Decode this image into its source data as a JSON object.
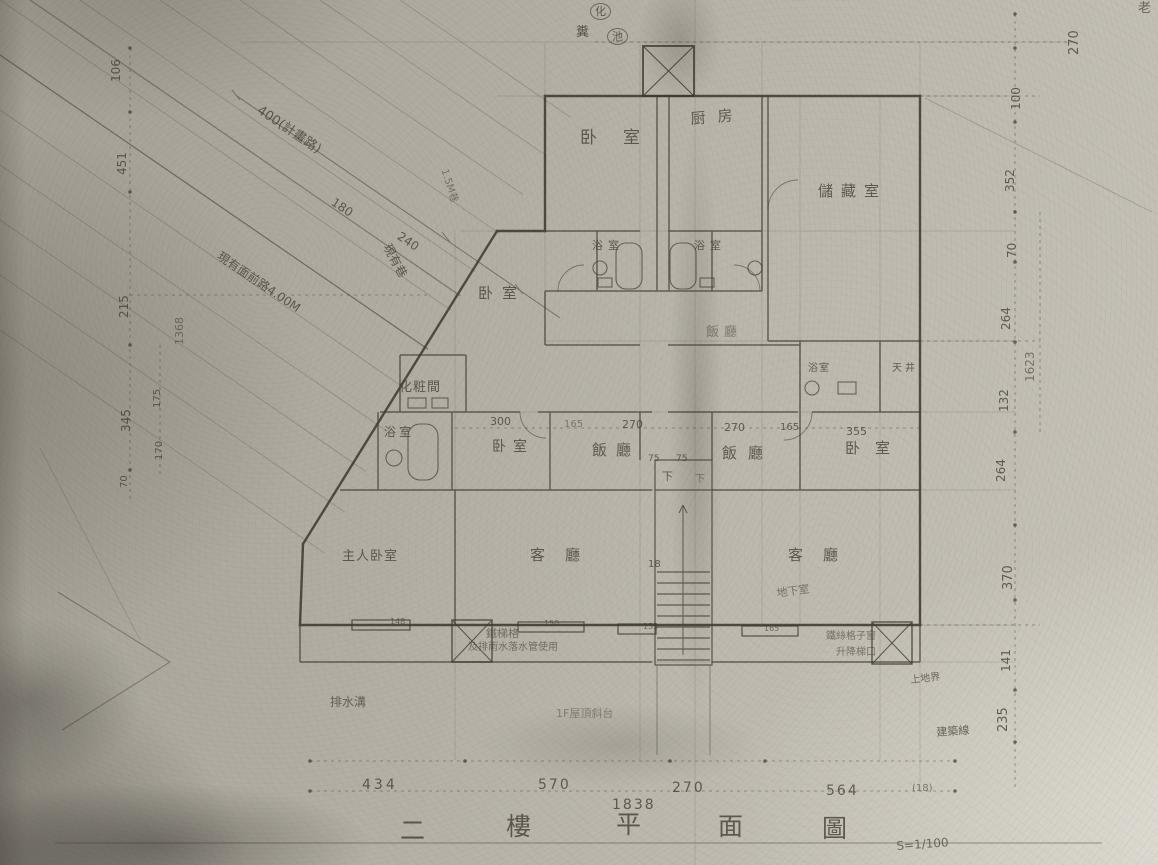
{
  "meta": {
    "doc_title": "二樓平面圖 S=1/100 (scanned floor plan)",
    "drawing_title_chars": [
      "二",
      "樓",
      "平",
      "面",
      "圖"
    ],
    "scale": "S=1/100",
    "floor": "二樓",
    "colors": {
      "paper": "#b8b4aa",
      "ink": "#453f35",
      "faint_ink": "#6b655a"
    }
  },
  "dimension_chains": {
    "bottom": [
      "434",
      "570",
      "270",
      "564"
    ],
    "bottom_total": "1838",
    "bottom_extra": "(18)",
    "middle_row": [
      "300",
      "165",
      "270",
      "270",
      "165",
      "355"
    ],
    "left_outer": [
      "106",
      "451",
      "215",
      "345"
    ],
    "left_inner": [
      "175",
      "170",
      "70"
    ],
    "left_subtotal": "1368",
    "right_outer": [
      "270",
      "100",
      "352",
      "70",
      "264",
      "132",
      "264",
      "370",
      "141",
      "235"
    ],
    "right_subtotal": "1623",
    "road": [
      "400(計畫路)",
      "180",
      "240"
    ],
    "stair": [
      "75",
      "75",
      "18"
    ],
    "wall_tags": [
      "148",
      "150",
      "155",
      "165"
    ]
  },
  "labels": [
    {
      "name": "room-bedroom-top",
      "text": "卧室",
      "x": 580,
      "y": 130,
      "fs": 17,
      "ls": 26
    },
    {
      "name": "room-kitchen",
      "text": "厨房",
      "x": 690,
      "y": 112,
      "fs": 15,
      "ls": 12,
      "rot": -5
    },
    {
      "name": "room-storage",
      "text": "儲藏室",
      "x": 818,
      "y": 184,
      "fs": 15,
      "ls": 8
    },
    {
      "name": "room-bath-a",
      "text": "浴室",
      "x": 592,
      "y": 240,
      "fs": 11,
      "ls": 5
    },
    {
      "name": "room-bath-b",
      "text": "浴室",
      "x": 694,
      "y": 240,
      "fs": 11,
      "ls": 5
    },
    {
      "name": "room-bedroom-left",
      "text": "卧室",
      "x": 478,
      "y": 286,
      "fs": 15,
      "ls": 9
    },
    {
      "name": "room-dining-upper",
      "text": "飯廳",
      "x": 706,
      "y": 326,
      "fs": 13,
      "ls": 5,
      "op": 0.5
    },
    {
      "name": "room-dressing",
      "text": "化粧間",
      "x": 399,
      "y": 381,
      "fs": 13,
      "ls": 1
    },
    {
      "name": "room-bath-c",
      "text": "浴室",
      "x": 384,
      "y": 426,
      "fs": 12,
      "ls": 3
    },
    {
      "name": "room-bedroom-mid",
      "text": "卧室",
      "x": 492,
      "y": 440,
      "fs": 14,
      "ls": 7
    },
    {
      "name": "room-dining-left",
      "text": "飯廳",
      "x": 592,
      "y": 443,
      "fs": 15,
      "ls": 9
    },
    {
      "name": "room-dining-right",
      "text": "飯廳",
      "x": 722,
      "y": 446,
      "fs": 15,
      "ls": 11
    },
    {
      "name": "room-bedroom-right",
      "text": "卧室",
      "x": 845,
      "y": 441,
      "fs": 15,
      "ls": 15
    },
    {
      "name": "room-bath-d",
      "text": "浴室",
      "x": 808,
      "y": 364,
      "fs": 10,
      "ls": 1
    },
    {
      "name": "room-lightwell",
      "text": "天井",
      "x": 892,
      "y": 364,
      "fs": 10,
      "ls": 3
    },
    {
      "name": "room-master-bedroom",
      "text": "主人卧室",
      "x": 342,
      "y": 550,
      "fs": 13,
      "ls": 1
    },
    {
      "name": "room-living-left",
      "text": "客廳",
      "x": 530,
      "y": 548,
      "fs": 15,
      "ls": 20
    },
    {
      "name": "room-living-right",
      "text": "客廳",
      "x": 788,
      "y": 548,
      "fs": 15,
      "ls": 20
    },
    {
      "name": "note-basement",
      "text": "地下室",
      "x": 776,
      "y": 588,
      "fs": 11,
      "rot": -8,
      "op": 0.6
    },
    {
      "name": "septic-tank-char-1",
      "text": "化",
      "x": 590,
      "y": 3,
      "fs": 11,
      "circle": true
    },
    {
      "name": "septic-tank-char-2",
      "text": "糞",
      "x": 576,
      "y": 26,
      "fs": 13
    },
    {
      "name": "septic-tank-char-3",
      "text": "池",
      "x": 607,
      "y": 28,
      "fs": 11,
      "circle": true
    },
    {
      "name": "note-planned-road",
      "text": "400(計畫路)",
      "x": 262,
      "y": 104,
      "fs": 13,
      "rot": 34
    },
    {
      "name": "dim-road-180",
      "text": "180",
      "x": 336,
      "y": 196,
      "fs": 12,
      "rot": 34
    },
    {
      "name": "dim-road-240",
      "text": "240",
      "x": 402,
      "y": 230,
      "fs": 12,
      "rot": 34
    },
    {
      "name": "note-existing-alley",
      "text": "現有巷",
      "x": 392,
      "y": 242,
      "fs": 12,
      "rot": 62
    },
    {
      "name": "note-alley-width",
      "text": "1.5M巷",
      "x": 448,
      "y": 168,
      "fs": 10,
      "rot": 72,
      "op": 0.55
    },
    {
      "name": "note-front-road",
      "text": "現有面前路4.00M",
      "x": 222,
      "y": 250,
      "fs": 12,
      "rot": 34
    },
    {
      "name": "note-iron-grille-1",
      "text": "鐵梯格",
      "x": 486,
      "y": 628,
      "fs": 11,
      "op": 0.6
    },
    {
      "name": "note-iron-grille-2",
      "text": "及排雨水落水管使用",
      "x": 468,
      "y": 643,
      "fs": 10,
      "op": 0.6
    },
    {
      "name": "note-wire-window-1",
      "text": "鐵絲格子窗",
      "x": 826,
      "y": 632,
      "fs": 10,
      "op": 0.6
    },
    {
      "name": "note-wire-window-2",
      "text": "升降梯口",
      "x": 836,
      "y": 648,
      "fs": 10,
      "op": 0.6
    },
    {
      "name": "note-gutter",
      "text": "排水溝",
      "x": 330,
      "y": 696,
      "fs": 12,
      "op": 0.7
    },
    {
      "name": "note-roof-terrace",
      "text": "1F屋頂斜台",
      "x": 556,
      "y": 708,
      "fs": 11,
      "op": 0.45
    },
    {
      "name": "note-site-boundary",
      "text": "上地界",
      "x": 910,
      "y": 676,
      "fs": 10,
      "rot": -6,
      "op": 0.7
    },
    {
      "name": "note-building-line",
      "text": "建築線",
      "x": 936,
      "y": 727,
      "fs": 11,
      "rot": -4,
      "op": 0.75
    },
    {
      "name": "note-top-right",
      "text": "老",
      "x": 1138,
      "y": 2,
      "fs": 13,
      "op": 0.7
    },
    {
      "name": "stair-down-a",
      "text": "下",
      "x": 662,
      "y": 471,
      "fs": 11
    },
    {
      "name": "stair-down-b",
      "text": "下",
      "x": 695,
      "y": 475,
      "fs": 10,
      "op": 0.55
    },
    {
      "name": "dim-stair-75a",
      "text": "75",
      "x": 648,
      "y": 455,
      "fs": 9
    },
    {
      "name": "dim-stair-75b",
      "text": "75",
      "x": 676,
      "y": 455,
      "fs": 9
    },
    {
      "name": "stair-count",
      "text": "18",
      "x": 648,
      "y": 560,
      "fs": 10
    },
    {
      "name": "dim-mid-300",
      "text": "300",
      "x": 490,
      "y": 416,
      "fs": 11
    },
    {
      "name": "dim-mid-165a",
      "text": "165",
      "x": 564,
      "y": 420,
      "fs": 10,
      "op": 0.5
    },
    {
      "name": "dim-mid-270a",
      "text": "270",
      "x": 622,
      "y": 419,
      "fs": 11
    },
    {
      "name": "dim-mid-270b",
      "text": "270",
      "x": 724,
      "y": 422,
      "fs": 11
    },
    {
      "name": "dim-mid-165b",
      "text": "165",
      "x": 780,
      "y": 423,
      "fs": 10
    },
    {
      "name": "dim-mid-355",
      "text": "355",
      "x": 846,
      "y": 426,
      "fs": 11
    },
    {
      "name": "wall-tag-148",
      "text": "148",
      "x": 390,
      "y": 618,
      "fs": 8,
      "op": 0.65
    },
    {
      "name": "wall-tag-150",
      "text": "150",
      "x": 544,
      "y": 620,
      "fs": 8,
      "op": 0.65
    },
    {
      "name": "wall-tag-155",
      "text": "155",
      "x": 643,
      "y": 623,
      "fs": 8,
      "op": 0.65
    },
    {
      "name": "wall-tag-165",
      "text": "165",
      "x": 764,
      "y": 625,
      "fs": 8,
      "op": 0.65
    },
    {
      "name": "dim-bottom-434",
      "text": "434",
      "x": 362,
      "y": 778,
      "fs": 14,
      "ls": 3
    },
    {
      "name": "dim-bottom-570",
      "text": "570",
      "x": 538,
      "y": 778,
      "fs": 14,
      "ls": 2
    },
    {
      "name": "dim-bottom-270",
      "text": "270",
      "x": 672,
      "y": 781,
      "fs": 14,
      "ls": 2
    },
    {
      "name": "dim-bottom-564",
      "text": "564",
      "x": 826,
      "y": 784,
      "fs": 14,
      "ls": 2
    },
    {
      "name": "dim-bottom-1838",
      "text": "1838",
      "x": 612,
      "y": 798,
      "fs": 14,
      "ls": 2
    },
    {
      "name": "dim-bottom-18",
      "text": "(18)",
      "x": 912,
      "y": 784,
      "fs": 10,
      "op": 0.6
    },
    {
      "name": "dim-left-106",
      "text": "106",
      "x": 110,
      "y": 82,
      "fs": 12,
      "rot": -90
    },
    {
      "name": "dim-left-451",
      "text": "451",
      "x": 116,
      "y": 175,
      "fs": 12,
      "rot": -90
    },
    {
      "name": "dim-left-215",
      "text": "215",
      "x": 118,
      "y": 318,
      "fs": 12,
      "rot": -90
    },
    {
      "name": "dim-left-1368",
      "text": "1368",
      "x": 174,
      "y": 345,
      "fs": 11,
      "rot": -90,
      "op": 0.6
    },
    {
      "name": "dim-left-345",
      "text": "345",
      "x": 120,
      "y": 432,
      "fs": 12,
      "rot": -90
    },
    {
      "name": "dim-left-175",
      "text": "175",
      "x": 153,
      "y": 408,
      "fs": 10,
      "rot": -90
    },
    {
      "name": "dim-left-170",
      "text": "170",
      "x": 155,
      "y": 460,
      "fs": 10,
      "rot": -90
    },
    {
      "name": "dim-left-70",
      "text": "70",
      "x": 120,
      "y": 488,
      "fs": 10,
      "rot": -90
    },
    {
      "name": "dim-right-270t",
      "text": "270",
      "x": 1068,
      "y": 55,
      "fs": 13,
      "rot": -90
    },
    {
      "name": "dim-right-100",
      "text": "100",
      "x": 1010,
      "y": 110,
      "fs": 12,
      "rot": -90
    },
    {
      "name": "dim-right-352",
      "text": "352",
      "x": 1004,
      "y": 192,
      "fs": 12,
      "rot": -90
    },
    {
      "name": "dim-right-70",
      "text": "70",
      "x": 1006,
      "y": 258,
      "fs": 12,
      "rot": -90
    },
    {
      "name": "dim-right-264a",
      "text": "264",
      "x": 1000,
      "y": 330,
      "fs": 12,
      "rot": -90
    },
    {
      "name": "dim-right-1623",
      "text": "1623",
      "x": 1024,
      "y": 382,
      "fs": 12,
      "rot": -90,
      "op": 0.6
    },
    {
      "name": "dim-right-132",
      "text": "132",
      "x": 998,
      "y": 412,
      "fs": 12,
      "rot": -90
    },
    {
      "name": "dim-right-264b",
      "text": "264",
      "x": 995,
      "y": 482,
      "fs": 12,
      "rot": -90
    },
    {
      "name": "dim-right-370",
      "text": "370",
      "x": 1002,
      "y": 590,
      "fs": 13,
      "rot": -90
    },
    {
      "name": "dim-right-141",
      "text": "141",
      "x": 1000,
      "y": 672,
      "fs": 12,
      "rot": -90
    },
    {
      "name": "dim-right-235",
      "text": "235",
      "x": 997,
      "y": 732,
      "fs": 13,
      "rot": -90
    },
    {
      "name": "title-char-1",
      "text": "二",
      "x": 400,
      "y": 818,
      "fs": 25,
      "op": 0.8
    },
    {
      "name": "title-char-2",
      "text": "樓",
      "x": 506,
      "y": 814,
      "fs": 25,
      "op": 0.8
    },
    {
      "name": "title-char-3",
      "text": "平",
      "x": 616,
      "y": 812,
      "fs": 25,
      "op": 0.8
    },
    {
      "name": "title-char-4",
      "text": "面",
      "x": 718,
      "y": 814,
      "fs": 25,
      "op": 0.8
    },
    {
      "name": "title-char-5",
      "text": "圖",
      "x": 822,
      "y": 816,
      "fs": 25,
      "op": 0.8
    },
    {
      "name": "title-scale",
      "text": "S=1/100",
      "x": 896,
      "y": 840,
      "fs": 12,
      "rot": -4,
      "op": 0.7
    }
  ]
}
